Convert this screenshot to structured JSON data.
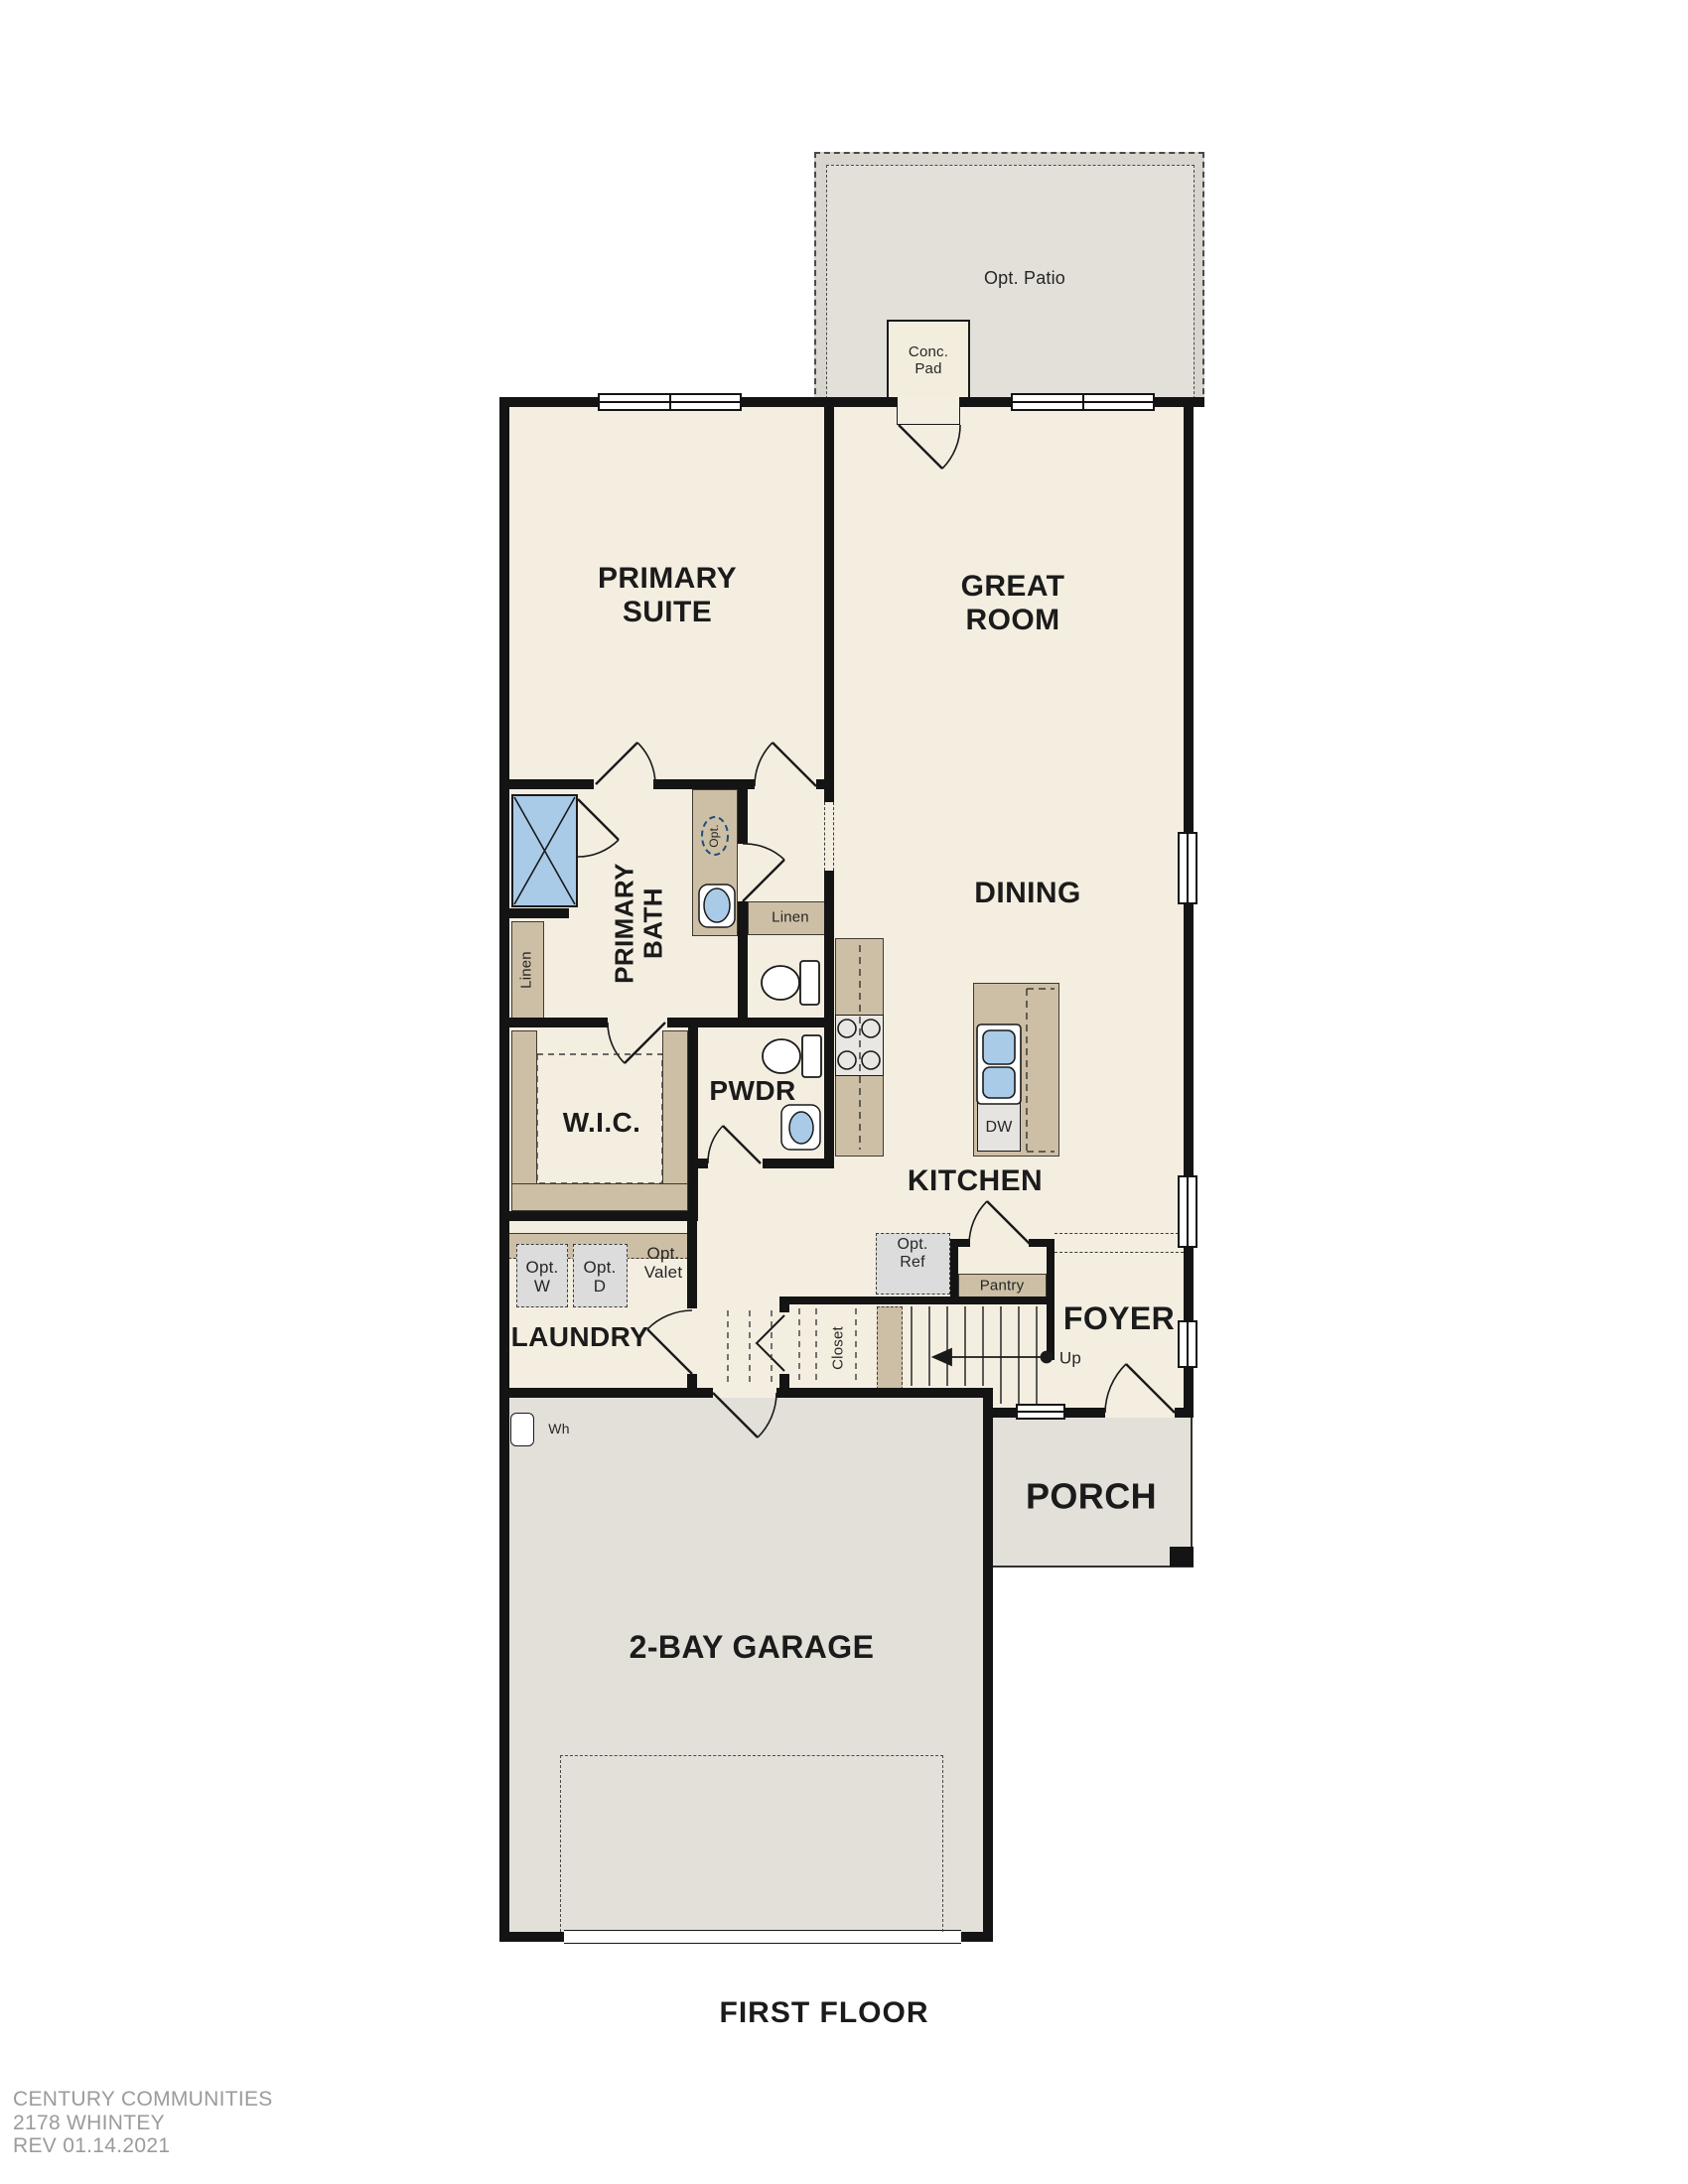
{
  "title": {
    "first_floor": "FIRST FLOOR"
  },
  "rooms": {
    "primary_suite": "PRIMARY SUITE",
    "great_room": "GREAT ROOM",
    "dining": "DINING",
    "primary_bath": "PRIMARY BATH",
    "wic": "W.I.C.",
    "pwdr": "PWDR",
    "kitchen": "KITCHEN",
    "laundry": "LAUNDRY",
    "foyer": "FOYER",
    "porch": "PORCH",
    "garage": "2-BAY GARAGE"
  },
  "annotations": {
    "opt_patio": "Opt. Patio",
    "conc_pad": "Conc. Pad",
    "linen_bath": "Linen",
    "linen_hall": "Linen",
    "opt_vanity": "Opt.",
    "dw": "DW",
    "opt_w": "Opt. W",
    "opt_d": "Opt. D",
    "opt_valet": "Opt. Valet",
    "opt_ref": "Opt. Ref",
    "pantry": "Pantry",
    "closet": "Closet",
    "up": "Up",
    "wh": "Wh"
  },
  "footer": {
    "company": "CENTURY COMMUNITIES",
    "plan": "2178 WHINTEY",
    "rev": "REV 01.14.2021"
  },
  "colors": {
    "room_fill": "#f4eee1",
    "outdoor_fill": "#e3e0da",
    "patio_band": "#d8d4ce",
    "cabinet_tan": "#cdbfa5",
    "fixture_blue": "#a9cbe8",
    "wall": "#141414",
    "option_gray": "#dcdcdc",
    "footer_gray": "#9b9b9b"
  }
}
